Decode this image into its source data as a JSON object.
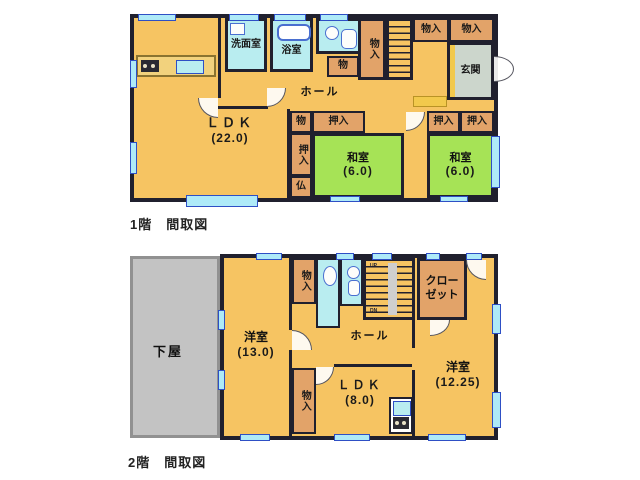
{
  "document": {
    "type": "floor-plan",
    "floor1_caption": "1階　間取図",
    "floor2_caption": "2階　間取図"
  },
  "floor1": {
    "rooms": {
      "ldk": {
        "name": "ＬＤＫ",
        "size": "(22.0)"
      },
      "washroom": {
        "name": "洗面室"
      },
      "bathroom": {
        "name": "浴室"
      },
      "hall": {
        "name": "ホール"
      },
      "storage_small_top": {
        "name": "物"
      },
      "storage_tall": {
        "name": "物入"
      },
      "storage_tr1": {
        "name": "物入"
      },
      "storage_tr2": {
        "name": "物入"
      },
      "entrance": {
        "name": "玄関"
      },
      "storage_mid": {
        "name": "物"
      },
      "closet_mid": {
        "name": "押入"
      },
      "closet_left": {
        "name": "押入"
      },
      "altar": {
        "name": "仏"
      },
      "closet_r1": {
        "name": "押入"
      },
      "closet_r2": {
        "name": "押入"
      },
      "washitsu1": {
        "name": "和室",
        "size": "(6.0)"
      },
      "washitsu2": {
        "name": "和室",
        "size": "(6.0)"
      }
    }
  },
  "floor2": {
    "rooms": {
      "geya": {
        "name": "下屋"
      },
      "yoshitsu13": {
        "name": "洋室",
        "size": "(13.0)"
      },
      "storage_top": {
        "name": "物入"
      },
      "storage_bottom": {
        "name": "物入"
      },
      "hall": {
        "name": "ホール"
      },
      "closet": {
        "name": "クローゼット"
      },
      "ldk": {
        "name": "ＬＤＫ",
        "size": "(8.0)"
      },
      "yoshitsu1225": {
        "name": "洋室",
        "size": "(12.25)"
      }
    },
    "stairs": {
      "up": "UP",
      "down": "DN"
    }
  },
  "colors": {
    "wall": "#20202e",
    "room_orange": "#f6c462",
    "tatami_green": "#a6e356",
    "wet_cyan": "#b9edf0",
    "closet_tan": "#e2a369",
    "lower_roof_gray": "#c3c3c3",
    "entrance_gray": "#ccd6cc",
    "window_fill": "#aeeaf8",
    "window_stroke": "#2e4fc5",
    "step_yellow": "#f2c94c"
  }
}
